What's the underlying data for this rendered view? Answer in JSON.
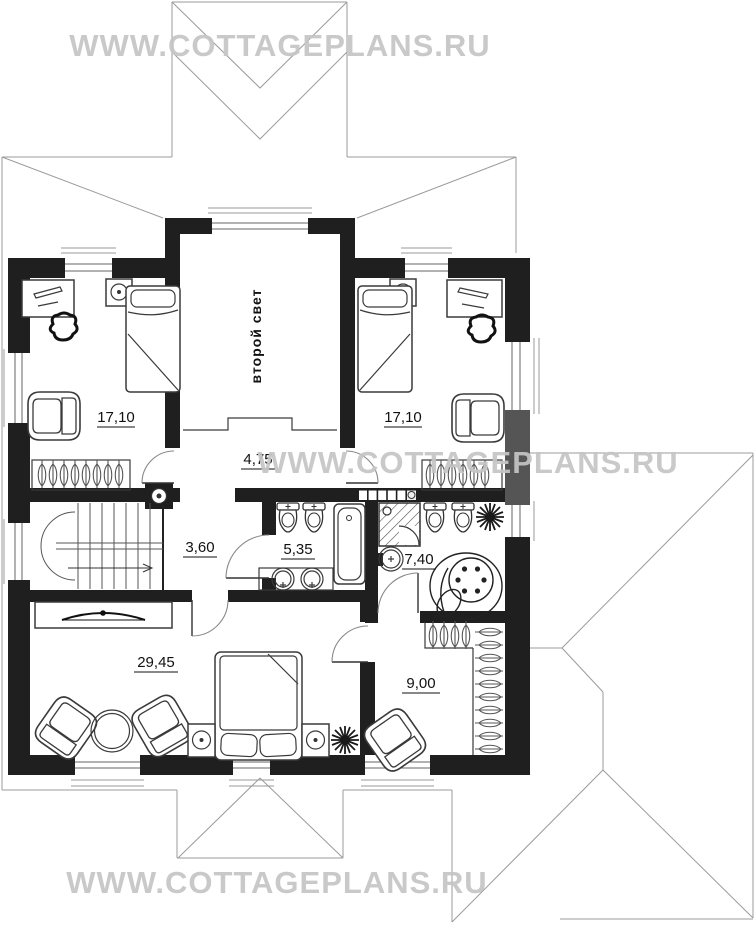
{
  "watermark": {
    "text": "WWW.COTTAGEPLANS.RU"
  },
  "plan": {
    "second_light_label": "второй свет",
    "rooms": {
      "bedroom_left": {
        "name": "bedroom-left",
        "area": "17,10"
      },
      "bedroom_right": {
        "name": "bedroom-right",
        "area": "17,10"
      },
      "corridor": {
        "name": "corridor",
        "area": "4,75"
      },
      "hall": {
        "name": "stair-hall",
        "area": "3,60"
      },
      "bathroom": {
        "name": "bathroom",
        "area": "5,35"
      },
      "master_bathroom": {
        "name": "master-bathroom",
        "area": "7,40"
      },
      "master_bedroom": {
        "name": "master-bedroom",
        "area": "29,45"
      },
      "dressing_room": {
        "name": "dressing-room",
        "area": "9,00"
      }
    }
  },
  "colors": {
    "wall": "#1f1f1f",
    "roof_line": "#9b9b9b",
    "watermark": "#c5c5c5",
    "gray_wall_segment": "#555555",
    "background": "#ffffff"
  }
}
